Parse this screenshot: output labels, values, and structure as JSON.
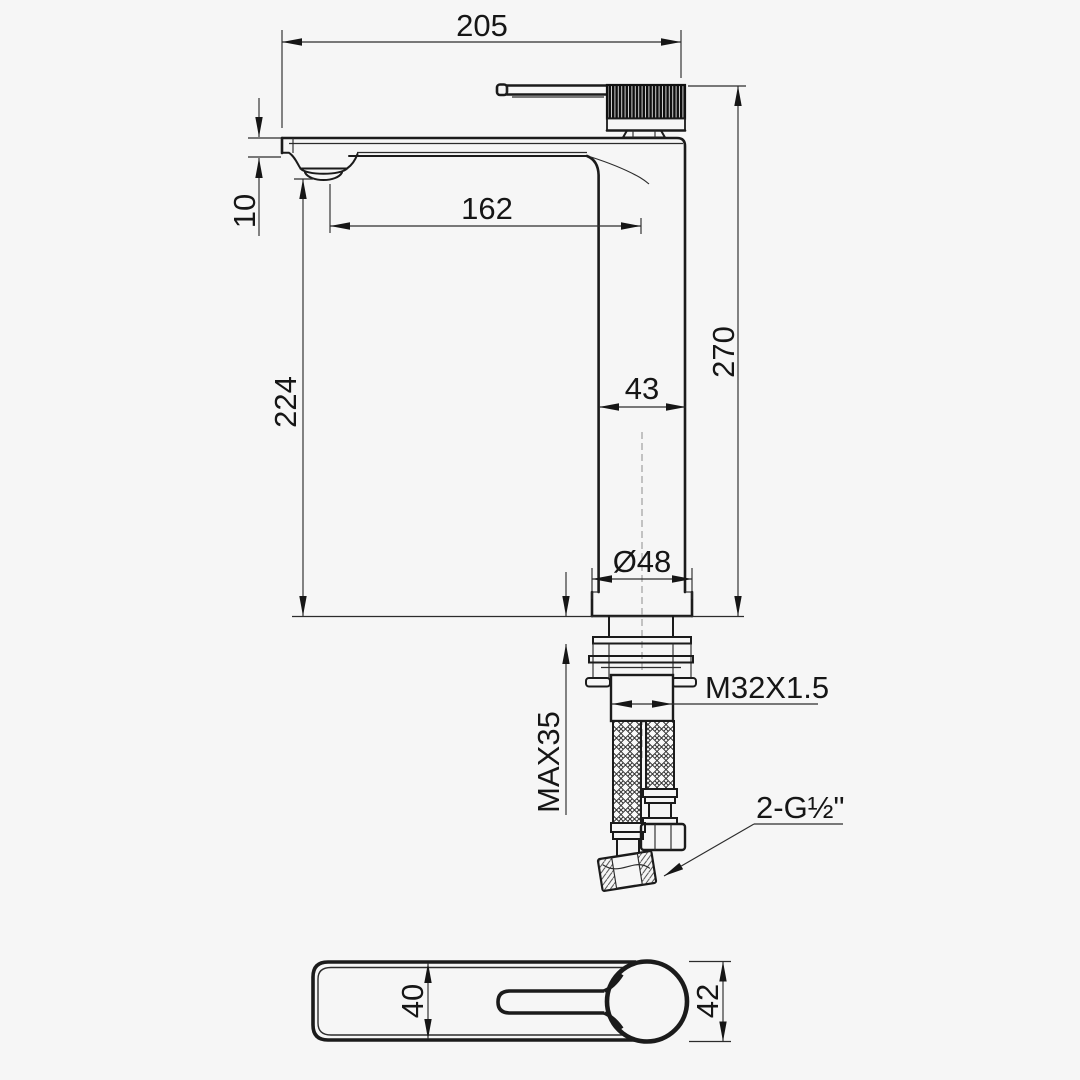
{
  "drawing": {
    "type": "faucet-installation-dimension-drawing",
    "colors": {
      "background": "#f6f6f6",
      "line": "#1b1b1b"
    },
    "side_view": {
      "overall_width": "205",
      "spout_reach": "162",
      "spout_thickness": "10",
      "spout_height": "224",
      "overall_height": "270",
      "body_width": "43",
      "base_diameter": "Ø48",
      "mounting_thread": "M32X1.5",
      "max_deck_thickness": "MAX35",
      "hose_connection": "2-G½\""
    },
    "plan_view": {
      "handle_width": "40",
      "knob_diameter": "42"
    }
  }
}
